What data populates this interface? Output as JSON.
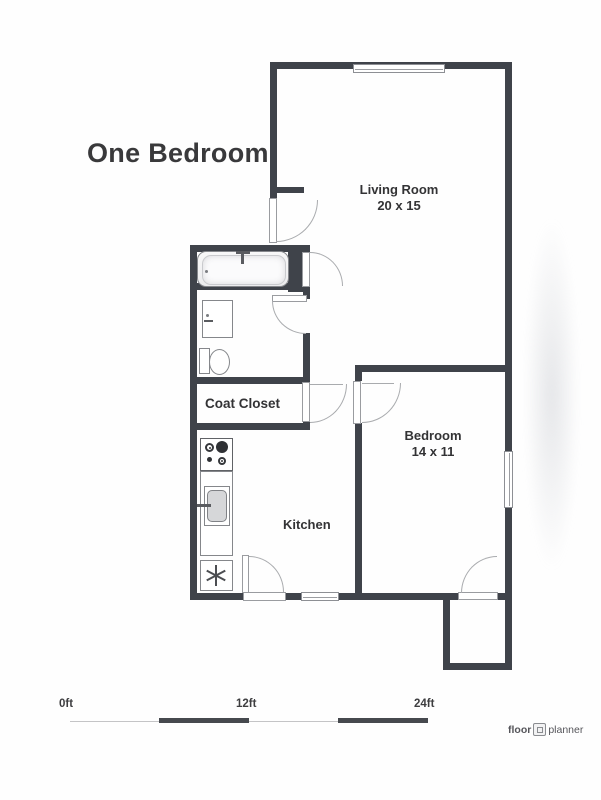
{
  "title": "One Bedroom",
  "rooms": {
    "living_room": {
      "name": "Living Room",
      "size": "20 x 15"
    },
    "bedroom": {
      "name": "Bedroom",
      "size": "14 x 11"
    },
    "kitchen": {
      "name": "Kitchen"
    },
    "coat_closet": {
      "name": "Coat Closet"
    }
  },
  "scale_bar": {
    "labels": [
      "0ft",
      "12ft",
      "24ft"
    ]
  },
  "logo": {
    "first": "floor",
    "second": "planner"
  },
  "colors": {
    "wall": "#3f434a",
    "text": "#3a3a3c",
    "fixture_line": "#85878b",
    "scale_bar": "#46494e"
  }
}
